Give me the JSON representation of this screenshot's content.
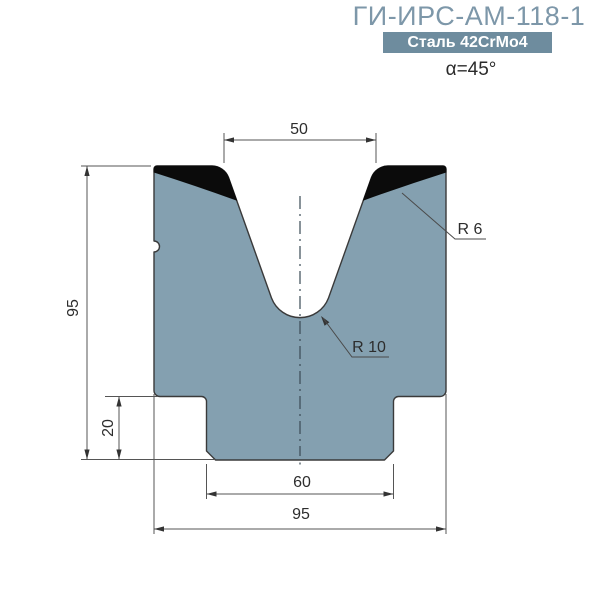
{
  "header": {
    "title": "ГИ-ИРС-АМ-118-1",
    "material": "Сталь 42CrMo4",
    "angle": "α=45°"
  },
  "dimensions": {
    "groove_width": "50",
    "height": "95",
    "step_height": "20",
    "base_width": "60",
    "total_width": "95"
  },
  "callouts": {
    "shoulder_radius": "R 6",
    "groove_radius": "R 10"
  },
  "colors": {
    "body_fill": "#84a0b0",
    "hardened_zone": "#0b0b0b",
    "outline": "#3a3a3a",
    "dimension_lines": "#555555",
    "dimension_text": "#2d2d2d",
    "title": "#7d97a9",
    "badge_background": "#6e8c9e",
    "badge_text": "#ffffff",
    "background": "#ffffff"
  }
}
